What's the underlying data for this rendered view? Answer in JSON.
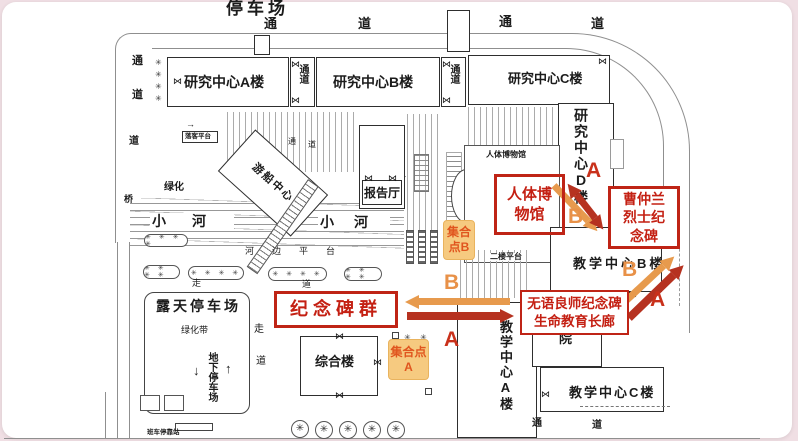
{
  "colors": {
    "page_background": "#f0dfe4",
    "card_background": "#ffffff",
    "map_line": "#2e2e2e",
    "route_a_red": "#c9311b",
    "route_b_orange": "#e89148",
    "annotation_red": "#bf2416",
    "assembly_bg": "#f6ca80",
    "assembly_text": "#e0551e"
  },
  "title": "停车场",
  "roads": {
    "tong": "通",
    "dao": "道",
    "qiao": "桥",
    "zou": "走"
  },
  "buildings": {
    "research_a": "研究中心A楼",
    "research_b": "研究中心B楼",
    "research_c": "研究中心C楼",
    "research_d": "研究中心D楼",
    "passage": "通道",
    "report_hall": "报告厅",
    "boat_center": "游船中心",
    "museum_small": "人体博物馆",
    "complex_building": "综合楼",
    "teaching_a": "教学中心A楼",
    "teaching_b": "教学中心B楼",
    "teaching_c": "教学中心C楼",
    "yuan": "院"
  },
  "places": {
    "pond": "水池",
    "river": "小河",
    "riverside_platform": "河边平台",
    "greenery": "绿化",
    "green_belt": "绿化带",
    "open_parking": "露天停车场",
    "underground_parking": "地下停车场",
    "second_floor_platform": "二楼平台",
    "bus_stop": "班车停靠站",
    "dropoff_platform": "落客平台",
    "down_arrow": "↓",
    "up_arrow": "↑"
  },
  "annotations": {
    "museum_box": "人体博物馆",
    "caozhonglan_box": "曹仲兰烈士纪念碑",
    "monuments_box": "纪念碑群",
    "silent_mentor_line1": "无语良师纪念碑",
    "silent_mentor_line2": "生命教育长廊",
    "assembly_a": "集合点A",
    "assembly_b": "集合点B",
    "route_a": "A",
    "route_b": "B"
  },
  "icons": {
    "tree": "✳",
    "door": "⋈",
    "planter": "✳ ✳ ✳ ✳"
  }
}
